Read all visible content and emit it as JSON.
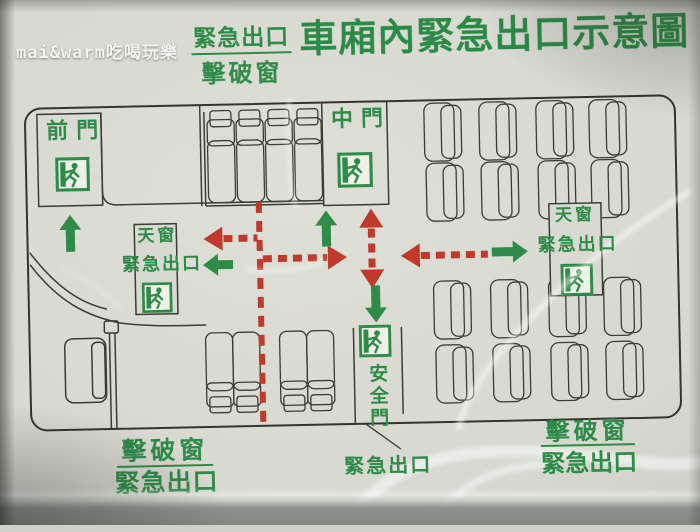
{
  "watermark": "mai&warm吃喝玩樂",
  "header": {
    "legend": {
      "line1": "緊急出口",
      "line2": "擊破窗"
    },
    "title": "車廂內緊急出口示意圖"
  },
  "diagram": {
    "front_door_label": "前門",
    "middle_door_label": "中門",
    "skylight_left": {
      "line1": "天窗",
      "line2": "緊急出口"
    },
    "skylight_right": {
      "line1": "天窗",
      "line2": "緊急出口"
    },
    "safety_door_label": "安全門",
    "bottom_left": {
      "line1": "擊破窗",
      "line2": "緊急出口"
    },
    "bottom_center": "緊急出口",
    "bottom_right": {
      "line1": "擊破窗",
      "line2": "緊急出口"
    }
  },
  "icons": {
    "exit": "running-man-exit-icon"
  },
  "colors": {
    "sign_green": "#2e8b48",
    "path_red": "#bf3a2b",
    "line_black": "#34342e",
    "sign_background": "#d8d9d1"
  }
}
